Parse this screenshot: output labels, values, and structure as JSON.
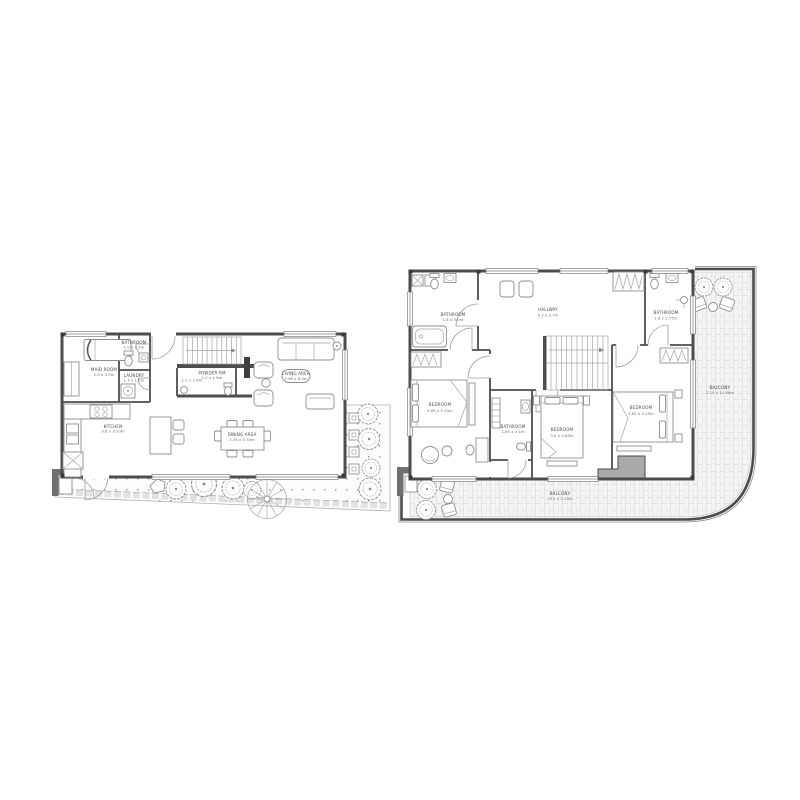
{
  "drawing": {
    "type": "architectural-floor-plan",
    "background": "#ffffff",
    "colors": {
      "wall": "#4d4d4d",
      "furniture_line": "#8f8f8f",
      "light_line": "#a5a5a5",
      "tile_line": "#dddddd",
      "paving_dot": "#a0a0a0",
      "block_fill": "#a9a9a9",
      "gate_fill": "#707070",
      "label_text": "#4a4a4a"
    },
    "floor1": {
      "rooms": {
        "maid": {
          "name": "MAID ROOM",
          "dims": "2.0 x 3.0m"
        },
        "bathroom": {
          "name": "BATHROOM",
          "dims": "1.0 x 1.5m"
        },
        "laundry": {
          "name": "LAUNDRY",
          "dims": "1.7 x 1.0m"
        },
        "kitchen": {
          "name": "KITCHEN",
          "dims": "3.8 x 3.33m"
        },
        "store_dims": "1.1 x 1.6m",
        "powder": {
          "name": "POWDER RM",
          "dims": "1.2 x 1.6m"
        },
        "dining": {
          "name": "DINING AREA",
          "dims": "3.35 x 3.30m"
        },
        "living": {
          "name": "LIVING AREA",
          "dims": "5.96 x 6.5m"
        }
      }
    },
    "floor2": {
      "rooms": {
        "bathroom_left": {
          "name": "BATHROOM",
          "dims": "1.8 x 3.0m"
        },
        "hallway": {
          "name": "HALLWAY",
          "dims": "5.3 x 2.7m"
        },
        "bathroom_right": {
          "name": "BATHROOM",
          "dims": "1.8 x 2.75m"
        },
        "bedroom_left": {
          "name": "BEDROOM",
          "dims": "5.65 x 5.15m"
        },
        "bathroom_mid": {
          "name": "BATHROOM",
          "dims": "1.65 x 3.1m"
        },
        "bedroom_mid": {
          "name": "BEDROOM",
          "dims": "3.5 x 4.65m"
        },
        "bedroom_right": {
          "name": "BEDROOM",
          "dims": "3.65 x 5.15m"
        },
        "balcony_right": {
          "name": "BALCONY",
          "dims": "2.15 x 11.68m"
        },
        "balcony_bottom": {
          "name": "BALCONY",
          "dims": "13.2 x 2.15m"
        }
      }
    }
  }
}
